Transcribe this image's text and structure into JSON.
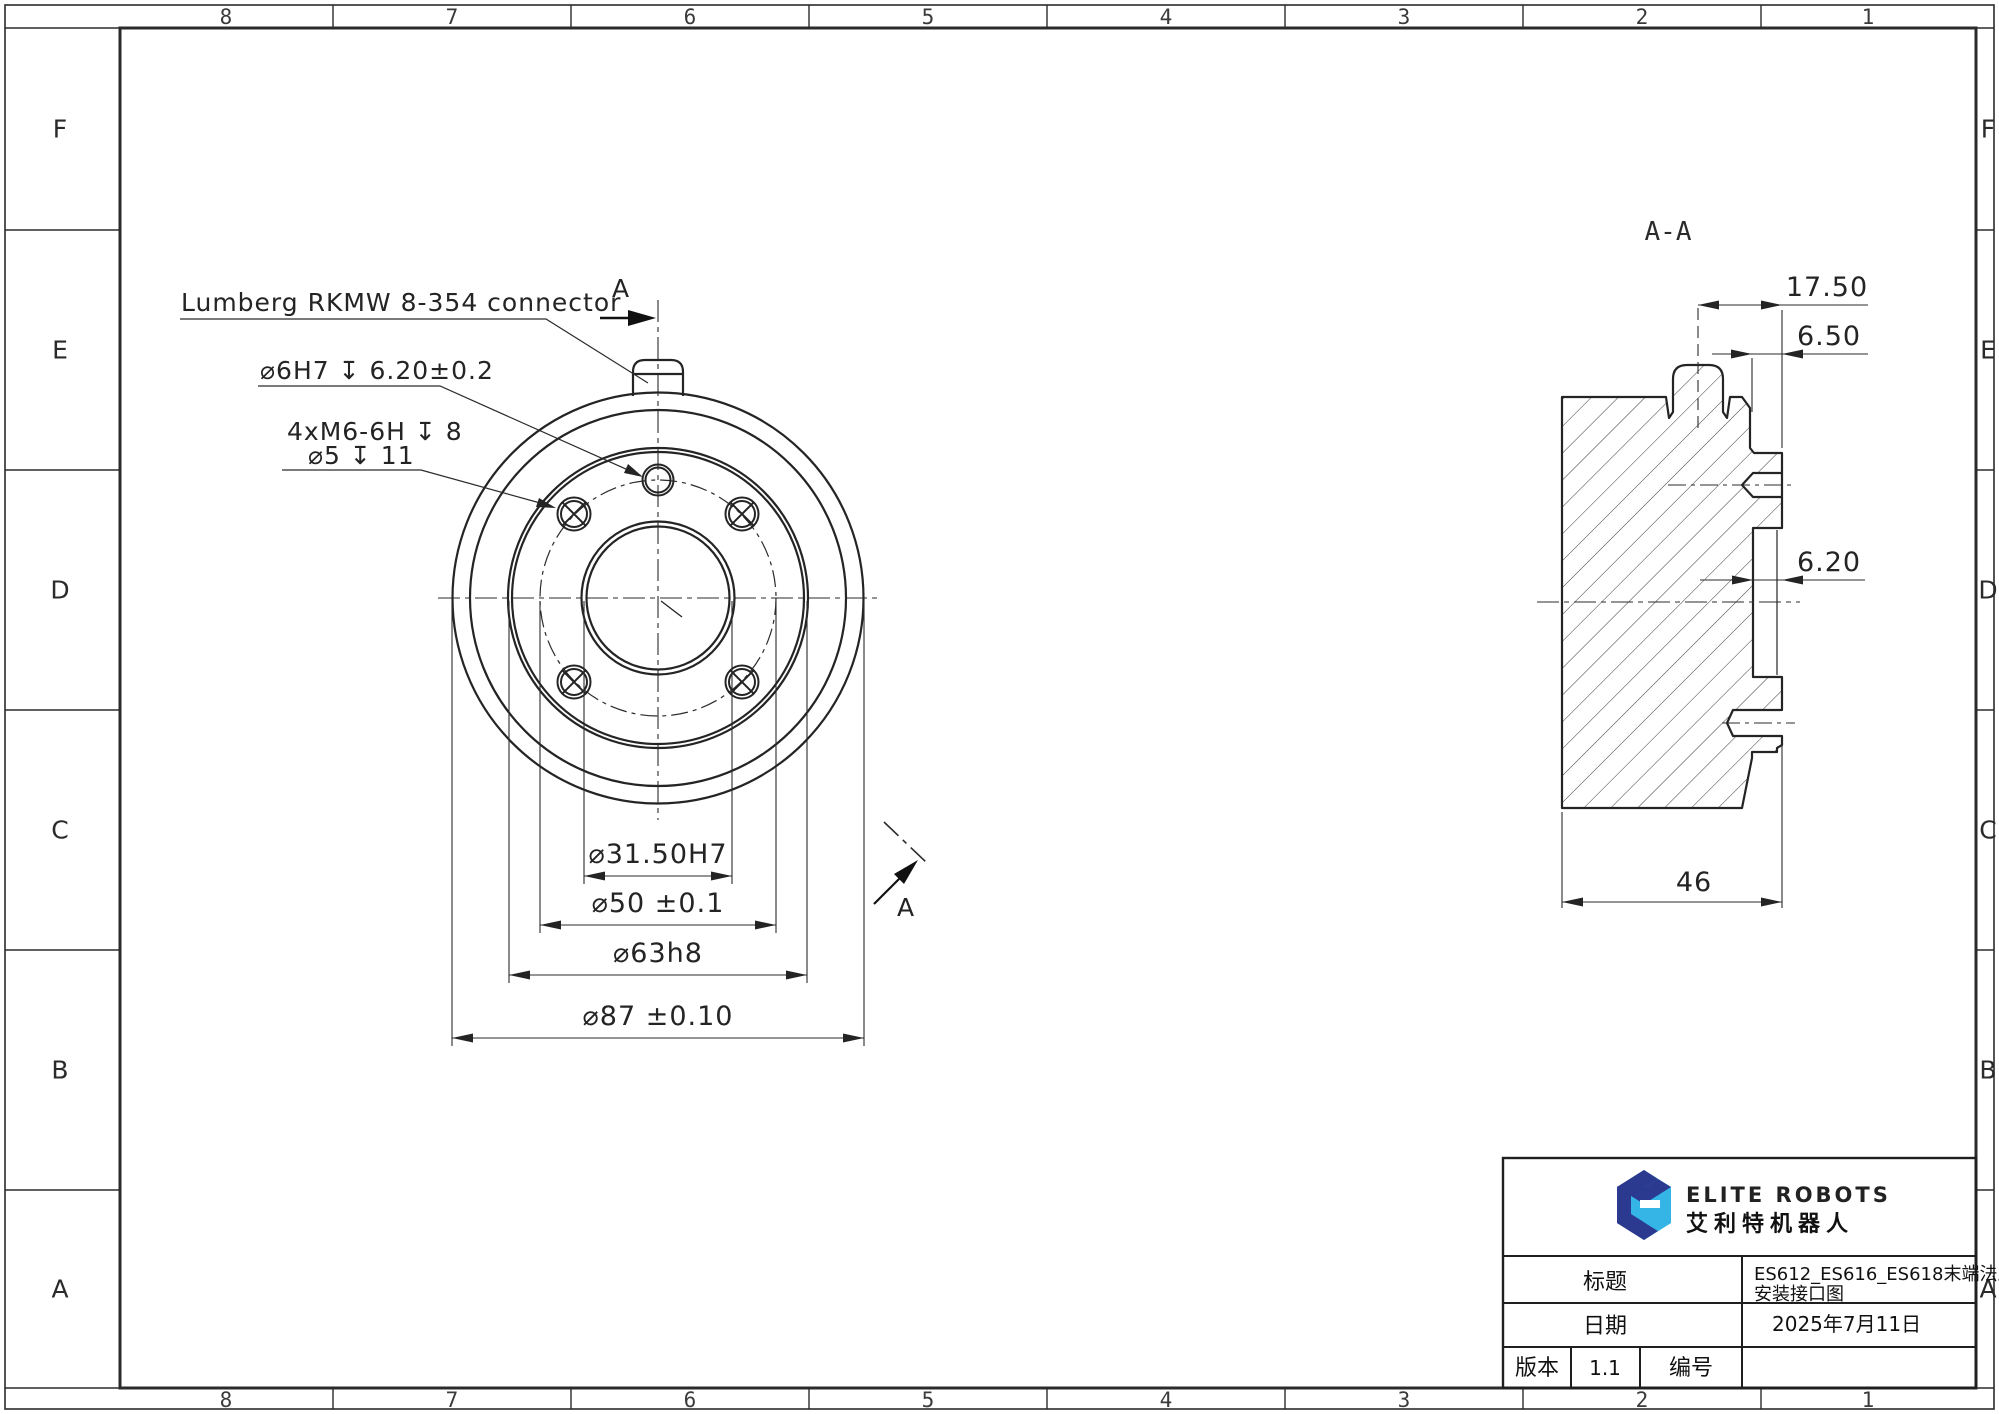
{
  "sheet": {
    "columns": [
      "8",
      "7",
      "6",
      "5",
      "4",
      "3",
      "2",
      "1"
    ],
    "rows": [
      "F",
      "E",
      "D",
      "C",
      "B",
      "A"
    ]
  },
  "front_view": {
    "connector_label": "Lumberg RKMW 8-354 connector",
    "dowel_label": "⌀6H7 ↧ 6.20±0.2",
    "bolt_label_1": "4xM6-6H ↧ 8",
    "bolt_label_2": "⌀5 ↧ 11",
    "dim_bore": "⌀31.50H7",
    "dim_bolt_circle": "⌀50 ±0.1",
    "dim_boss": "⌀63h8",
    "dim_outer": "⌀87 ±0.10",
    "section_letter": "A"
  },
  "section_view": {
    "title": "A-A",
    "dim_connector_offset": "17.50",
    "dim_connector_width": "6.50",
    "dim_recess_depth": "6.20",
    "dim_thickness": "46"
  },
  "title_block": {
    "brand_en": "ELITE ROBOTS",
    "brand_cn": "艾利特机器人",
    "title_label": "标题",
    "title_value_line1": "ES612_ES616_ES618末端法兰",
    "title_value_line2": "安装接口图",
    "date_label": "日期",
    "date_value": "2025年7月11日",
    "version_label": "版本",
    "version_value": "1.1",
    "number_label": "编号"
  },
  "colors": {
    "brand_light_blue": "#35b5e5",
    "brand_dark_blue": "#2b3a8f",
    "line": "#2b2b2b"
  }
}
